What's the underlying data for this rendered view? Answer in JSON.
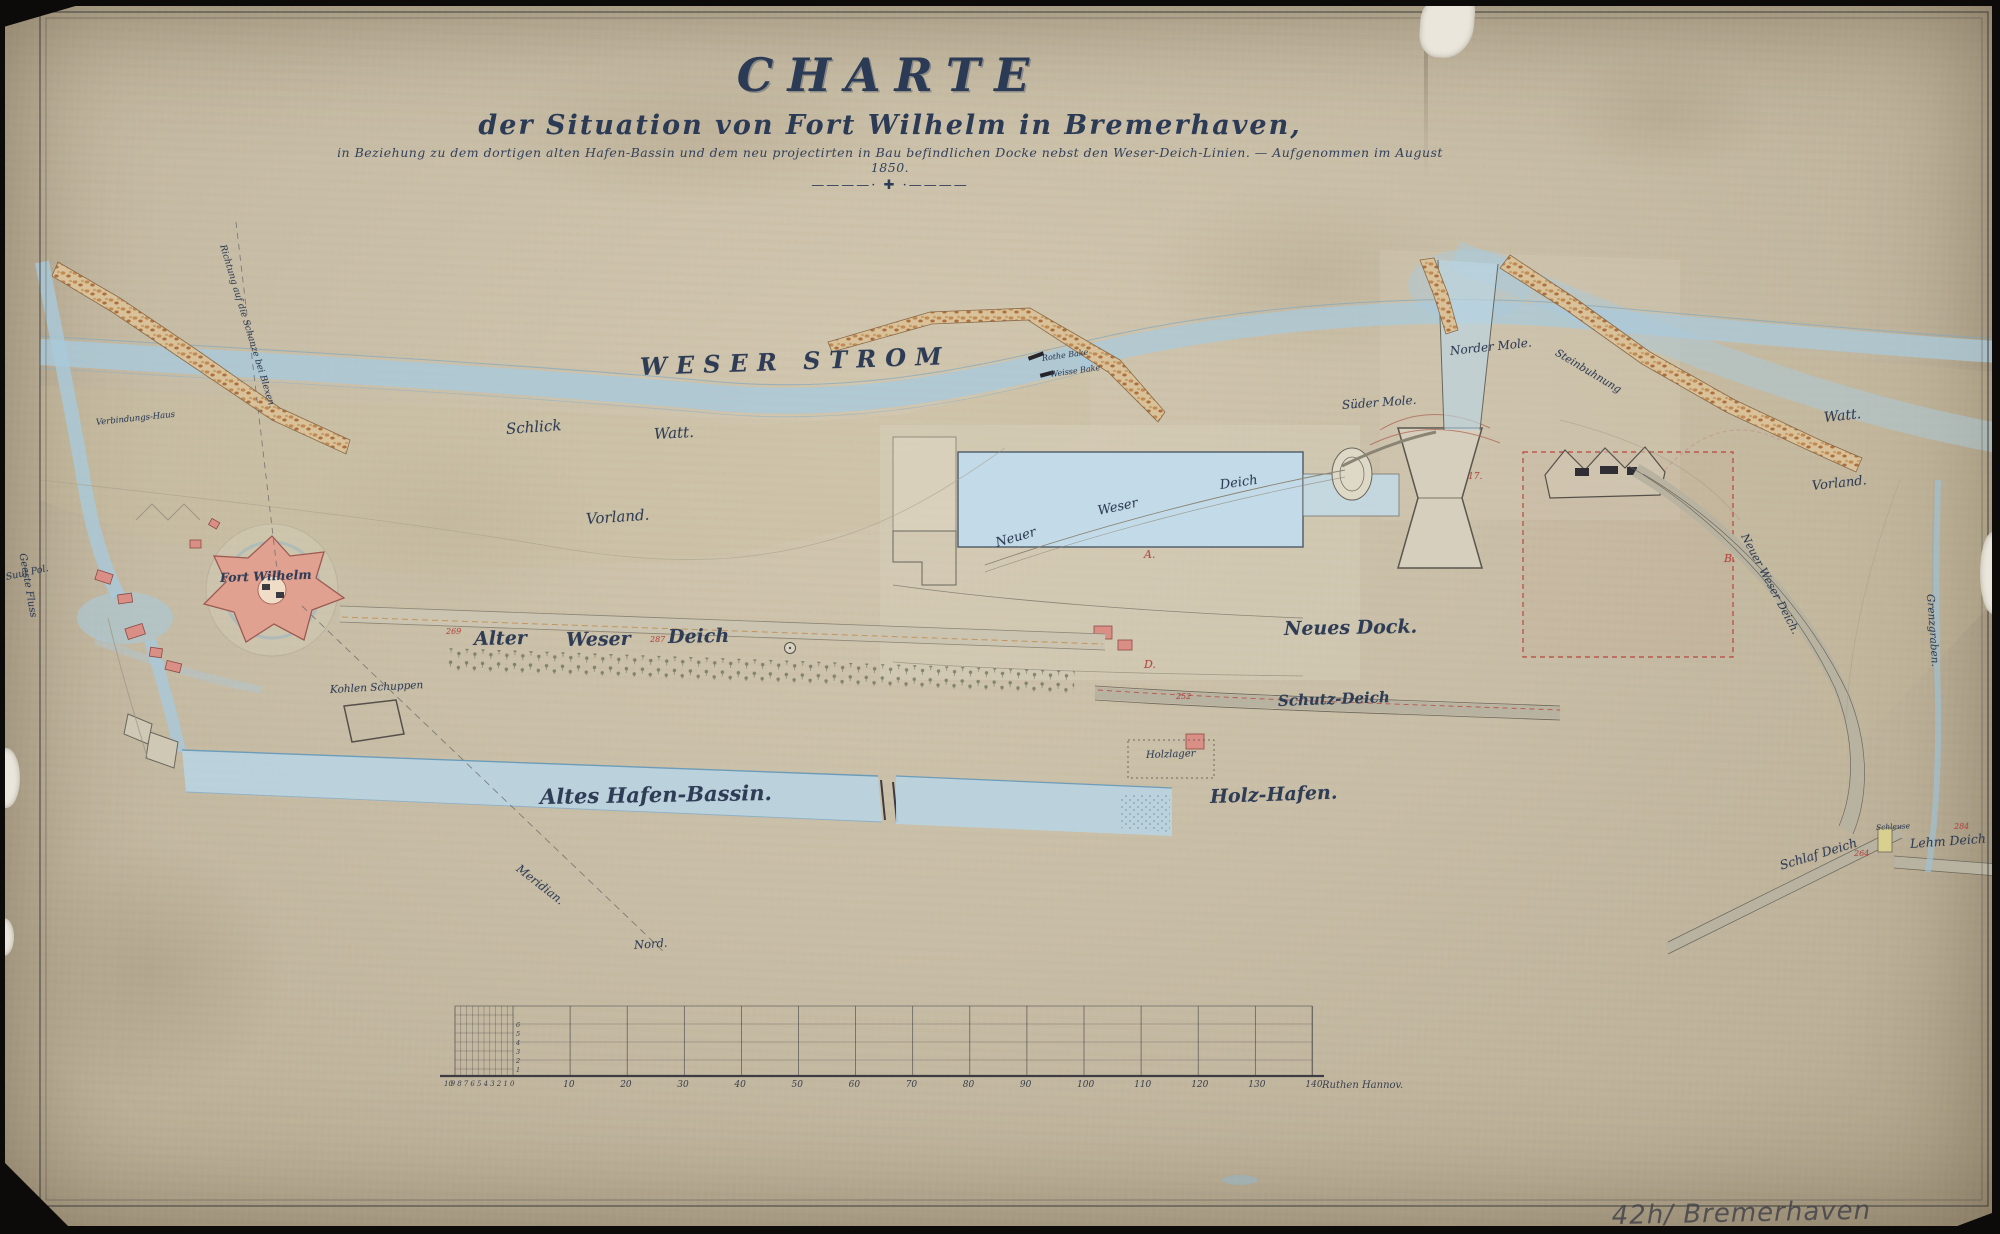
{
  "header": {
    "title": "CHARTE",
    "subtitle": "der Situation von Fort Wilhelm in Bremerhaven,",
    "dedication_line": "in Beziehung zu dem dortigen alten Hafen-Bassin und dem neu projectirten in Bau befindlichen Docke nebst den Weser-Deich-Linien. — Aufgenommen im August 1850.",
    "ornament": "————· ✚ ·————"
  },
  "annotations": {
    "pencil_note": "42h/ Bremerhaven 15"
  },
  "colors": {
    "paper": "#c8bda6",
    "ink": "#2e3c55",
    "water": "#a9c9db",
    "water_edge": "#7fa8c0",
    "land_wash": "#c6c09a",
    "jetty_stone": "#c08a52",
    "fort_pink": "#e0a191",
    "red_annotation": "#b8463e",
    "dike_band": "#b8b2a0",
    "pencil": "#44444a"
  },
  "map_labels": [
    {
      "id": "weser-strom",
      "t": "WESER STROM",
      "x": 640,
      "y": 352,
      "s": 24,
      "r": -2,
      "c": "caps"
    },
    {
      "id": "schlick",
      "t": "Schlick",
      "x": 506,
      "y": 420,
      "s": 15,
      "r": -4,
      "c": ""
    },
    {
      "id": "watt-west",
      "t": "Watt.",
      "x": 654,
      "y": 425,
      "s": 15,
      "r": -3,
      "c": ""
    },
    {
      "id": "vorland-west",
      "t": "Vorland.",
      "x": 586,
      "y": 510,
      "s": 15,
      "r": -4,
      "c": ""
    },
    {
      "id": "fort-wilhelm",
      "t": "Fort Wilhelm",
      "x": 220,
      "y": 570,
      "s": 12.5,
      "r": -2,
      "c": "bold"
    },
    {
      "id": "alter-weser-deich-1",
      "t": "Alter",
      "x": 474,
      "y": 628,
      "s": 19,
      "r": -1,
      "c": "bold"
    },
    {
      "id": "alter-weser-deich-2",
      "t": "Weser",
      "x": 566,
      "y": 629,
      "s": 19,
      "r": -1,
      "c": "bold"
    },
    {
      "id": "alter-weser-deich-3",
      "t": "Deich",
      "x": 668,
      "y": 626,
      "s": 19,
      "r": -1,
      "c": "bold"
    },
    {
      "id": "altes-hafen-bassin",
      "t": "Altes Hafen-Bassin.",
      "x": 540,
      "y": 784,
      "s": 21,
      "r": -1,
      "c": "bold"
    },
    {
      "id": "holz-hafen",
      "t": "Holz-Hafen.",
      "x": 1210,
      "y": 786,
      "s": 19,
      "r": -2,
      "c": "bold"
    },
    {
      "id": "holzlager",
      "t": "Holzlager",
      "x": 1146,
      "y": 750,
      "s": 10,
      "r": -2,
      "c": ""
    },
    {
      "id": "neues-dock",
      "t": "Neues Dock.",
      "x": 1284,
      "y": 618,
      "s": 19,
      "r": -1,
      "c": "bold"
    },
    {
      "id": "schutz-deich",
      "t": "Schutz-Deich",
      "x": 1278,
      "y": 692,
      "s": 15,
      "r": -2,
      "c": "bold"
    },
    {
      "id": "norder-mole",
      "t": "Norder Mole.",
      "x": 1450,
      "y": 344,
      "s": 12,
      "r": -6,
      "c": ""
    },
    {
      "id": "sueder-mole",
      "t": "Süder Mole.",
      "x": 1342,
      "y": 398,
      "s": 12,
      "r": -4,
      "c": ""
    },
    {
      "id": "steinbuhnung",
      "t": "Steinbuhnung",
      "x": 1556,
      "y": 346,
      "s": 10.5,
      "r": 31,
      "c": ""
    },
    {
      "id": "watt-east",
      "t": "Watt.",
      "x": 1824,
      "y": 410,
      "s": 14,
      "r": -6,
      "c": ""
    },
    {
      "id": "vorland-east",
      "t": "Vorland.",
      "x": 1812,
      "y": 479,
      "s": 13,
      "r": -6,
      "c": ""
    },
    {
      "id": "grenzgraben",
      "t": "Grenzgraben.",
      "x": 1930,
      "y": 588,
      "s": 10.5,
      "r": 86,
      "c": ""
    },
    {
      "id": "neuer-weser-deich-east",
      "t": "Neuer Weser Deich.",
      "x": 1744,
      "y": 528,
      "s": 11,
      "r": 62,
      "c": ""
    },
    {
      "id": "schlaf-deich",
      "t": "Schlaf Deich",
      "x": 1780,
      "y": 858,
      "s": 12.5,
      "r": -17,
      "c": ""
    },
    {
      "id": "lehm-deich",
      "t": "Lehm Deich",
      "x": 1910,
      "y": 836,
      "s": 12.5,
      "r": -4,
      "c": ""
    },
    {
      "id": "schleuse",
      "t": "Schleuse",
      "x": 1876,
      "y": 823,
      "s": 7.5,
      "r": -3,
      "c": ""
    },
    {
      "id": "meridian",
      "t": "Meridian.",
      "x": 518,
      "y": 860,
      "s": 11.5,
      "r": 38,
      "c": ""
    },
    {
      "id": "nord",
      "t": "Nord.",
      "x": 634,
      "y": 938,
      "s": 11.5,
      "r": -4,
      "c": ""
    },
    {
      "id": "richtung",
      "t": "Richtung auf die Schanze bei Blexen.",
      "x": 222,
      "y": 240,
      "s": 9,
      "r": 73,
      "c": ""
    },
    {
      "id": "kohlen-schuppen",
      "t": "Kohlen Schuppen",
      "x": 330,
      "y": 684,
      "s": 10.5,
      "r": -3,
      "c": ""
    },
    {
      "id": "verbindungs-haus",
      "t": "Verbindungs-Haus",
      "x": 96,
      "y": 418,
      "s": 8.5,
      "r": -6,
      "c": ""
    },
    {
      "id": "geeste-fluss",
      "t": "Geeste Fluss",
      "x": 22,
      "y": 548,
      "s": 10,
      "r": 80,
      "c": ""
    },
    {
      "id": "suut-pol",
      "t": "Suut Pol.",
      "x": 6,
      "y": 572,
      "s": 9.5,
      "r": -12,
      "c": ""
    },
    {
      "id": "rothe-bake",
      "t": "Rothe Bake",
      "x": 1042,
      "y": 354,
      "s": 8,
      "r": -8,
      "c": ""
    },
    {
      "id": "weisse-bake",
      "t": "Weisse Bake",
      "x": 1050,
      "y": 370,
      "s": 8,
      "r": -8,
      "c": ""
    },
    {
      "id": "neuer-deich-mid-1",
      "t": "Neuer",
      "x": 996,
      "y": 536,
      "s": 13,
      "r": -16,
      "c": ""
    },
    {
      "id": "neuer-deich-mid-2",
      "t": "Weser",
      "x": 1098,
      "y": 504,
      "s": 13,
      "r": -12,
      "c": ""
    },
    {
      "id": "neuer-deich-mid-3",
      "t": "Deich",
      "x": 1220,
      "y": 478,
      "s": 13,
      "r": -8,
      "c": ""
    },
    {
      "id": "num-269",
      "t": "269",
      "x": 446,
      "y": 627,
      "s": 8,
      "r": 0,
      "c": "red"
    },
    {
      "id": "num-287",
      "t": "287",
      "x": 650,
      "y": 635,
      "s": 8,
      "r": 0,
      "c": "red"
    },
    {
      "id": "num-264",
      "t": "264",
      "x": 1854,
      "y": 849,
      "s": 8,
      "r": 0,
      "c": "red"
    },
    {
      "id": "num-284",
      "t": "284",
      "x": 1954,
      "y": 822,
      "s": 8,
      "r": 0,
      "c": "red"
    },
    {
      "id": "num-252",
      "t": "252",
      "x": 1176,
      "y": 692,
      "s": 8,
      "r": 0,
      "c": "red"
    },
    {
      "id": "letter-a",
      "t": "A.",
      "x": 1144,
      "y": 548,
      "s": 11,
      "r": 0,
      "c": "red"
    },
    {
      "id": "letter-d",
      "t": "D.",
      "x": 1144,
      "y": 658,
      "s": 11,
      "r": 0,
      "c": "red"
    },
    {
      "id": "letter-b",
      "t": "B.",
      "x": 1724,
      "y": 552,
      "s": 11,
      "r": 0,
      "c": "red"
    },
    {
      "id": "num-17",
      "t": "17.",
      "x": 1468,
      "y": 472,
      "s": 9,
      "r": 0,
      "c": "red"
    }
  ],
  "scale_bar": {
    "fine_labels": [
      "10",
      "9",
      "8",
      "7",
      "6",
      "5",
      "4",
      "3",
      "2",
      "1",
      "0"
    ],
    "major_labels": [
      "10",
      "20",
      "30",
      "40",
      "50",
      "60",
      "70",
      "80",
      "90",
      "100",
      "110",
      "120",
      "130",
      "140"
    ],
    "unit_caption": "Ruthen Hannov.",
    "row_labels": [
      "1",
      "2",
      "3",
      "4",
      "5",
      "6"
    ]
  }
}
